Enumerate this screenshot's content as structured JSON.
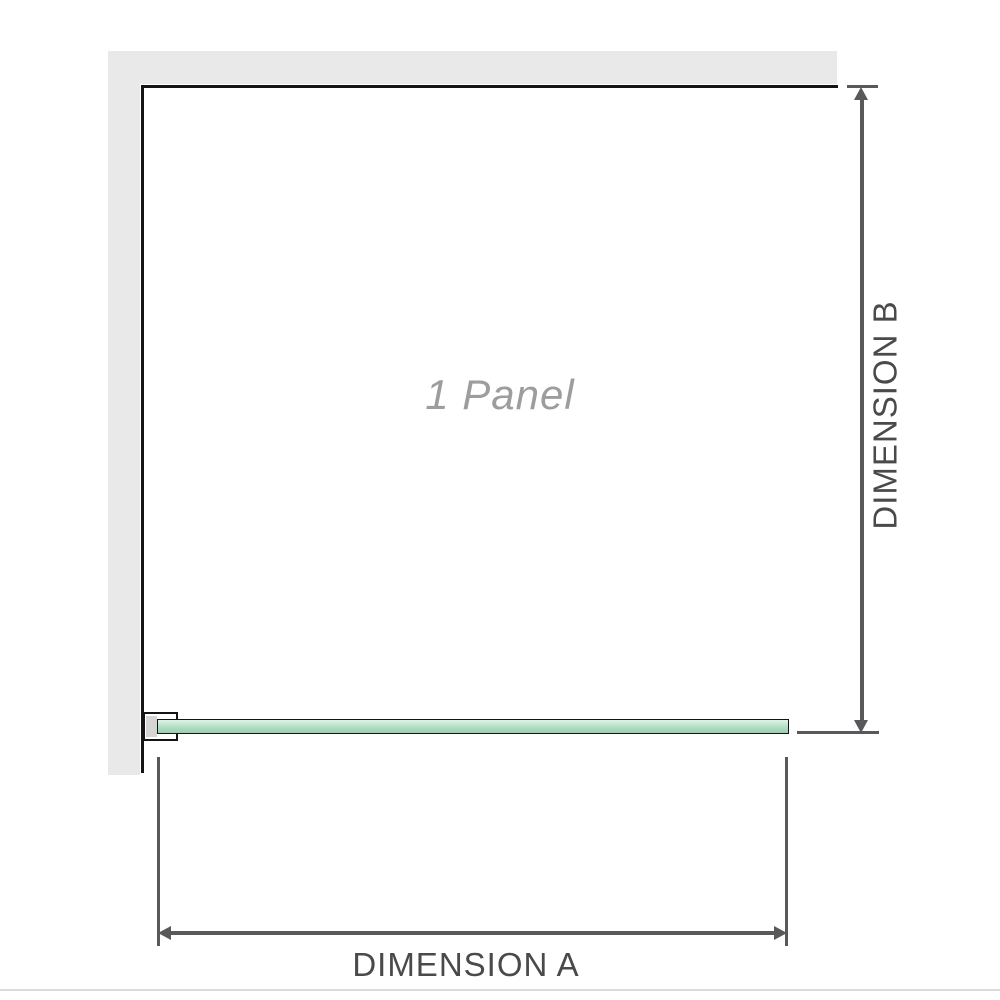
{
  "watermark": {
    "text": "1 Panel"
  },
  "dimensions": {
    "a": {
      "label": "DIMENSION A"
    },
    "b": {
      "label": "DIMENSION B"
    }
  },
  "colors": {
    "wall": "#e9e9e9",
    "outline": "#141414",
    "glass_top": "#dff2e7",
    "glass_mid": "#b2ddc4",
    "glass_bottom": "#97d0ae",
    "dimension_line": "#59595b",
    "dimension_text": "#4a4a4a",
    "watermark_text": "#9d9d9d",
    "bracket_pad": "#d5d5d5",
    "footer_line": "#dcdcdc"
  }
}
